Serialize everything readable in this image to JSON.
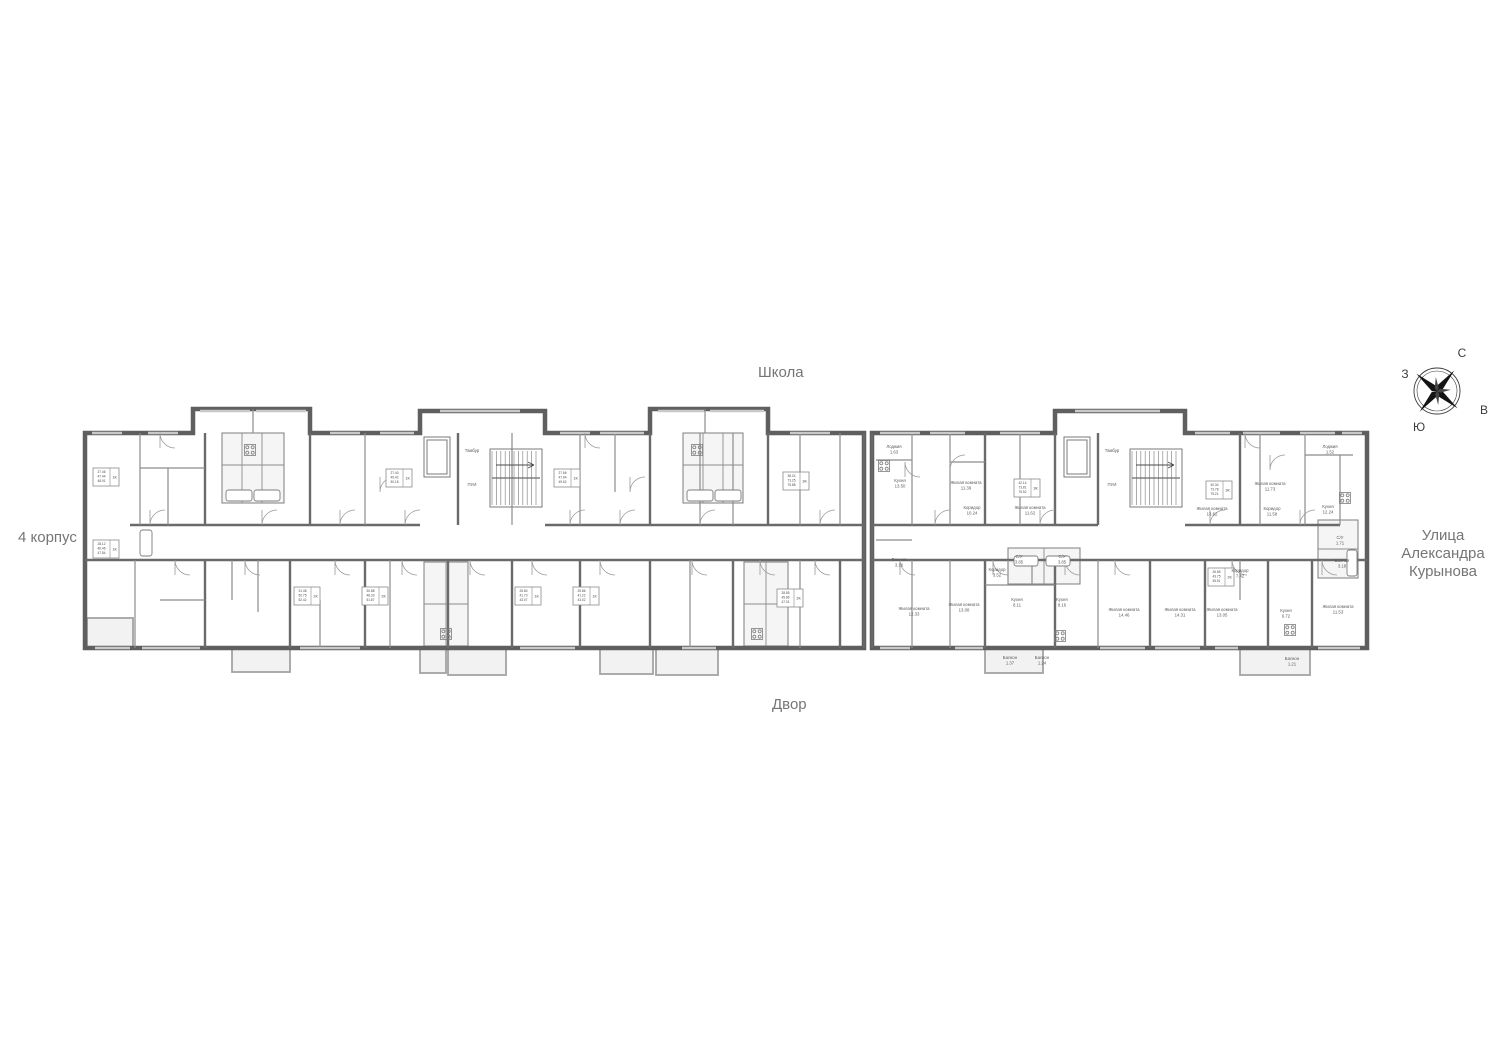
{
  "labels": {
    "school": "Школа",
    "building": "4 корпус",
    "street_line1": "Улица",
    "street_line2": "Александра",
    "street_line3": "Курынова",
    "yard": "Двор"
  },
  "compass": {
    "north": "С",
    "east": "В",
    "south": "Ю",
    "west": "З"
  },
  "rooms": [
    {
      "name": "Тамбур",
      "area": "",
      "x": 472,
      "y": 452
    },
    {
      "name": "ПУИ",
      "area": "",
      "x": 472,
      "y": 486
    },
    {
      "name": "Тамбур",
      "area": "",
      "x": 1112,
      "y": 452
    },
    {
      "name": "ПУИ",
      "area": "",
      "x": 1112,
      "y": 486
    },
    {
      "name": "Лоджия",
      "area": "1.63",
      "x": 894,
      "y": 448
    },
    {
      "name": "Кухня",
      "area": "13.50",
      "x": 900,
      "y": 482
    },
    {
      "name": "Жилая комната",
      "area": "11.39",
      "x": 966,
      "y": 484
    },
    {
      "name": "Коридор",
      "area": "10.24",
      "x": 972,
      "y": 509
    },
    {
      "name": "Жилая комната",
      "area": "11.62",
      "x": 1030,
      "y": 509
    },
    {
      "name": "Ванная",
      "area": "3.16",
      "x": 899,
      "y": 561
    },
    {
      "name": "Жилая комната",
      "area": "12.33",
      "x": 914,
      "y": 610
    },
    {
      "name": "Жилая комната",
      "area": "13.08",
      "x": 964,
      "y": 606
    },
    {
      "name": "Коридор",
      "area": "3.52",
      "x": 997,
      "y": 571
    },
    {
      "name": "С/У",
      "area": "3.85",
      "x": 1019,
      "y": 558
    },
    {
      "name": "С/У",
      "area": "3.85",
      "x": 1062,
      "y": 558
    },
    {
      "name": "Кухня",
      "area": "8.11",
      "x": 1017,
      "y": 601
    },
    {
      "name": "Кухня",
      "area": "8.16",
      "x": 1062,
      "y": 601
    },
    {
      "name": "Балкон",
      "area": "1.37",
      "x": 1010,
      "y": 659
    },
    {
      "name": "Балкон",
      "area": "1.24",
      "x": 1042,
      "y": 659
    },
    {
      "name": "Жилая комната",
      "area": "14.46",
      "x": 1124,
      "y": 611
    },
    {
      "name": "Жилая комната",
      "area": "14.31",
      "x": 1180,
      "y": 611
    },
    {
      "name": "Жилая комната",
      "area": "13.62",
      "x": 1212,
      "y": 510
    },
    {
      "name": "Жилая комната",
      "area": "11.73",
      "x": 1270,
      "y": 485
    },
    {
      "name": "Коридор",
      "area": "11.58",
      "x": 1272,
      "y": 510
    },
    {
      "name": "Кухня",
      "area": "12.24",
      "x": 1328,
      "y": 508
    },
    {
      "name": "Лоджия",
      "area": "1.52",
      "x": 1330,
      "y": 448
    },
    {
      "name": "С/У",
      "area": "1.71",
      "x": 1340,
      "y": 539
    },
    {
      "name": "Ванная",
      "area": "3.18",
      "x": 1342,
      "y": 562
    },
    {
      "name": "Коридор",
      "area": "7.42",
      "x": 1240,
      "y": 572
    },
    {
      "name": "Жилая комната",
      "area": "13.05",
      "x": 1222,
      "y": 611
    },
    {
      "name": "Кухня",
      "area": "6.72",
      "x": 1286,
      "y": 612
    },
    {
      "name": "Жилая комната",
      "area": "11.53",
      "x": 1338,
      "y": 608
    },
    {
      "name": "Балкон",
      "area": "1.21",
      "x": 1292,
      "y": 660
    }
  ],
  "stamps": [
    {
      "x": 93,
      "y": 468,
      "lines": [
        "27.46",
        "47.44",
        "48.91"
      ],
      "tag": "1К"
    },
    {
      "x": 93,
      "y": 540,
      "lines": [
        "28.12",
        "46.46",
        "47.84"
      ],
      "tag": "1К"
    },
    {
      "x": 386,
      "y": 469,
      "lines": [
        "27.40",
        "49.42",
        "50.18"
      ],
      "tag": "1К"
    },
    {
      "x": 554,
      "y": 469,
      "lines": [
        "27.66",
        "47.94",
        "49.62"
      ],
      "tag": "1К"
    },
    {
      "x": 294,
      "y": 587,
      "lines": [
        "31.48",
        "50.75",
        "52.42"
      ],
      "tag": "2К"
    },
    {
      "x": 362,
      "y": 587,
      "lines": [
        "30.88",
        "48.33",
        "51.87"
      ],
      "tag": "2К"
    },
    {
      "x": 515,
      "y": 587,
      "lines": [
        "25.80",
        "41.73",
        "43.07"
      ],
      "tag": "1К"
    },
    {
      "x": 573,
      "y": 587,
      "lines": [
        "25.86",
        "41.22",
        "43.02"
      ],
      "tag": "1К"
    },
    {
      "x": 783,
      "y": 472,
      "lines": [
        "38.24",
        "73.25",
        "75.88"
      ],
      "tag": "3К"
    },
    {
      "x": 777,
      "y": 589,
      "lines": [
        "28.85",
        "45.86",
        "47.01"
      ],
      "tag": "2К"
    },
    {
      "x": 1014,
      "y": 479,
      "lines": [
        "42.14",
        "73.81",
        "75.52"
      ],
      "tag": "3К"
    },
    {
      "x": 1206,
      "y": 481,
      "lines": [
        "40.34",
        "73.78",
        "75.21"
      ],
      "tag": "3К"
    },
    {
      "x": 1208,
      "y": 568,
      "lines": [
        "26.85",
        "43.75",
        "45.51"
      ],
      "tag": "2К"
    }
  ]
}
